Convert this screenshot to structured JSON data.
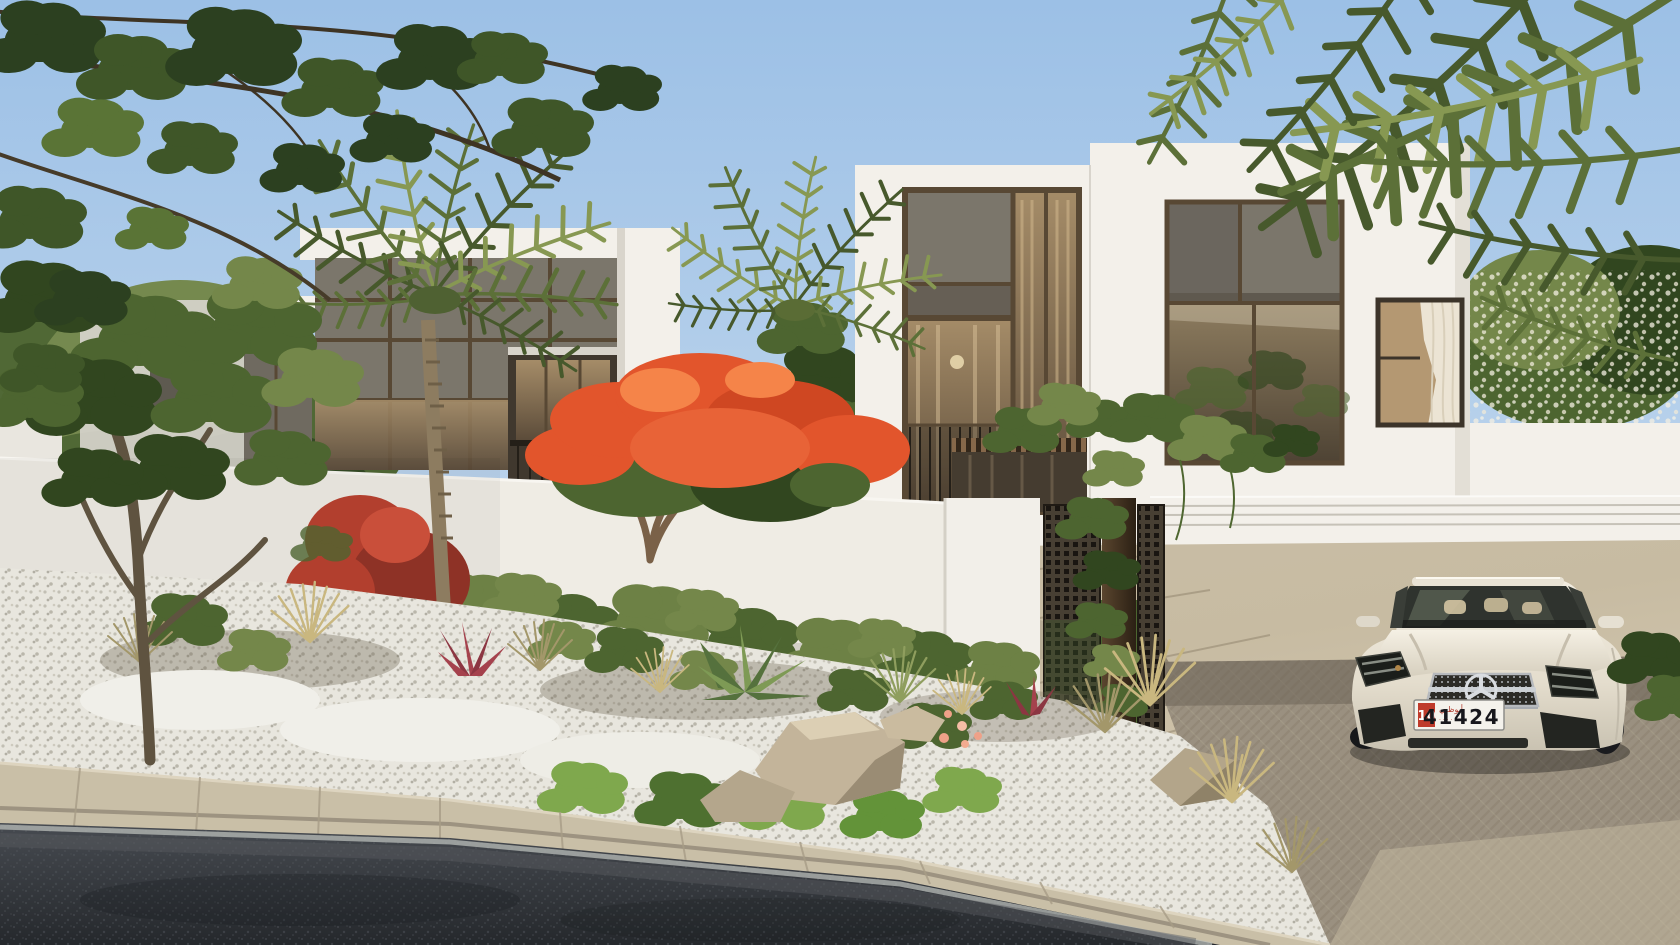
{
  "meta": {
    "description": "Photorealistic rendering of modern two-storey white villas with dark stone window panels, palm trees, flame tree with orange blossoms, white perimeter wall with bronze mesh pedestrian gate, carport with white Mercedes coupe, stone paved driveway, landscaped gravel bed with rocks and grasses, asphalt road in foreground, blue sky with overhanging branches and palm fronds",
    "width": 1680,
    "height": 945
  },
  "license_plate": {
    "category": "10",
    "number": "41424",
    "emirate_script": "أبوظبي",
    "emirate_sub": "· · · · ·"
  },
  "colors": {
    "sky_top": "#9cc0e6",
    "sky_bottom": "#d6e4f2",
    "wall_white": "#f3f0ea",
    "wall_shade": "#e3dfd6",
    "panel_dark": "#6f6a60",
    "panel_dark2": "#7b766b",
    "bronze": "#584834",
    "glass_warm": "#9a8465",
    "glass_deep": "#5a4b3a",
    "foliage_dark": "#31461f",
    "foliage_mid": "#4d6530",
    "foliage_light": "#74874a",
    "palm_green": "#5c7038",
    "palm_light": "#879852",
    "flame_orange": "#e2552c",
    "bougainvillea": "#b23f2e",
    "hedge_green": "#6d8145",
    "lawn": "#8fae55",
    "pave_light": "#d6cab1",
    "pave_mid": "#c0b49c",
    "road": "#3a3e44",
    "curb": "#c9bfa7",
    "gravel": "#e8e6de",
    "rock": "#c3b49a",
    "car_body": "#ece7da",
    "plate_red": "#bf3a2b",
    "wood": "#86684a",
    "mesh_dark": "#473f33"
  },
  "scene": {
    "objects": [
      "sky",
      "overhanging-branches",
      "palm-fronds-overhang",
      "left-garden-tree",
      "left-villa",
      "main-villa",
      "carport",
      "white-flower-tree",
      "perimeter-wall",
      "pedestrian-gate",
      "climbing-vine",
      "flame-tree",
      "palm-trees",
      "hedge-row",
      "driveway-pavement",
      "garden-bed",
      "rocks",
      "agave",
      "ornamental-grasses",
      "curb",
      "asphalt-road",
      "mercedes-car",
      "license-plate"
    ]
  }
}
